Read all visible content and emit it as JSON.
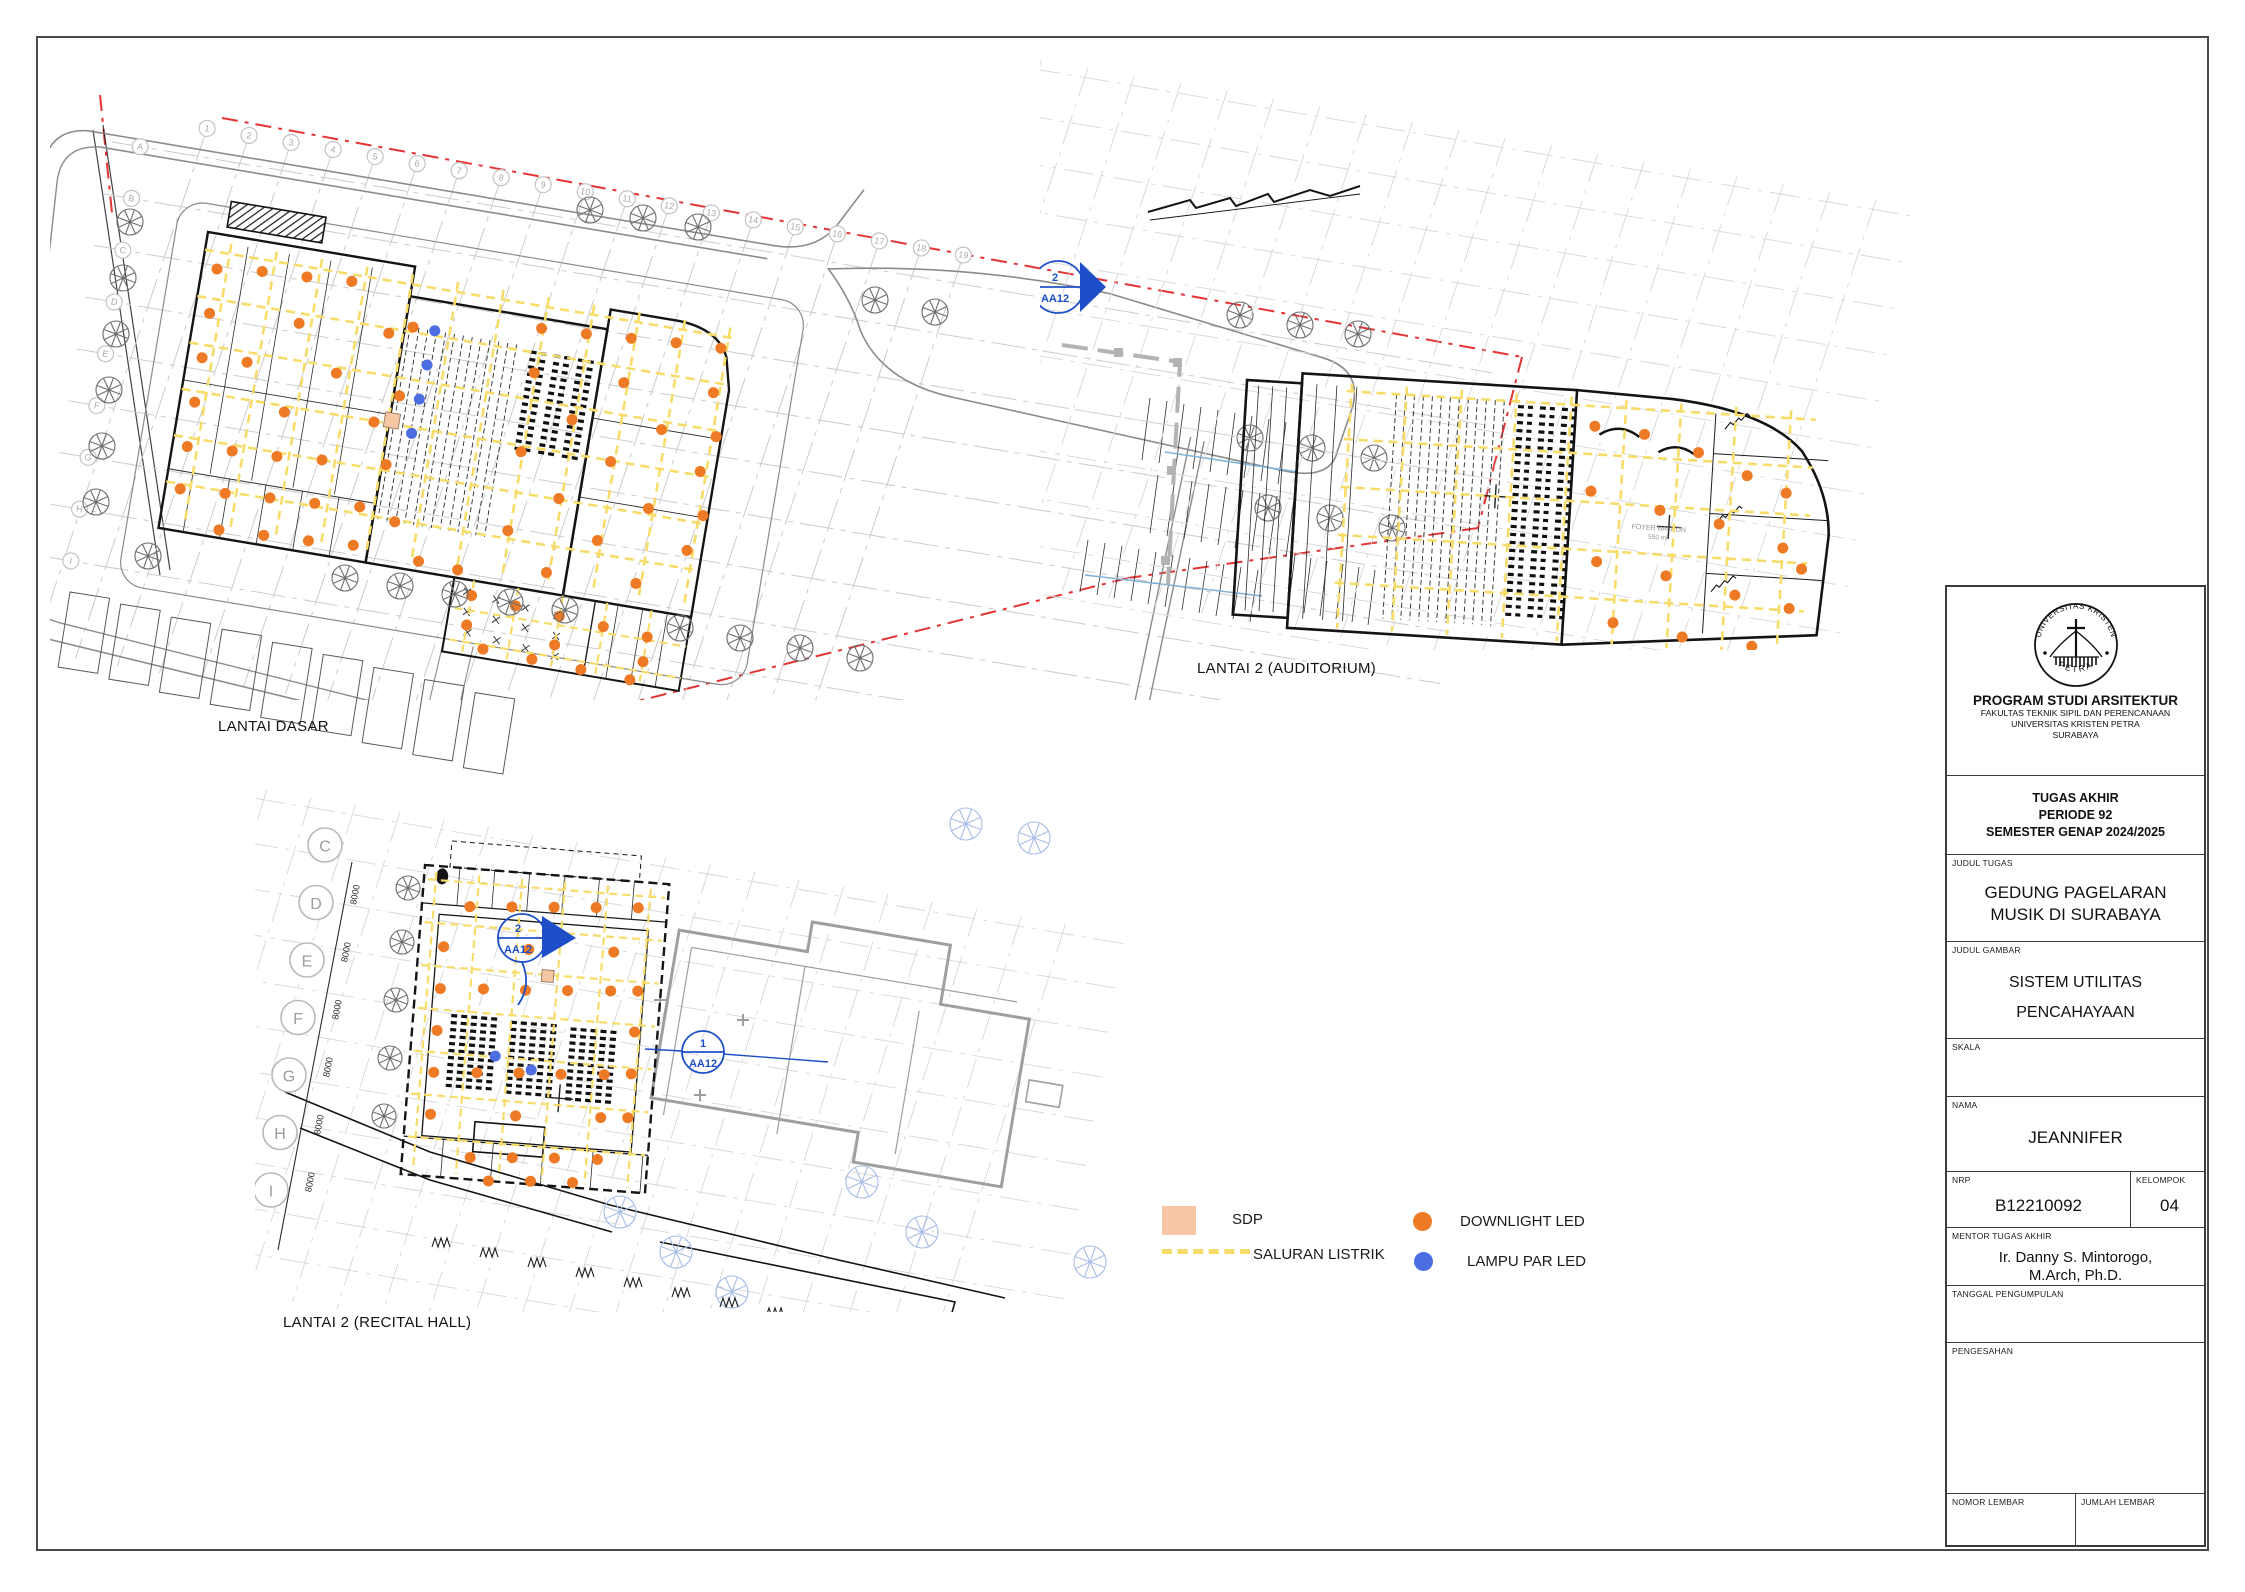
{
  "sheet": {
    "background": "#ffffff",
    "border_color": "#4a4a4a"
  },
  "colors": {
    "downlight": "#ee7a25",
    "lampu_par": "#4d6ee3",
    "saluran": "#f8dc6a",
    "sdp": "#f6c6a5",
    "boundary_red": "#e63434",
    "section_blue": "#1f4fc8",
    "tree_gray": "#6e6e6e",
    "tree_blue": "#a7bde6"
  },
  "plans": {
    "site": {
      "label": "LANTAI DASAR",
      "grid_numbers": [
        "1",
        "2",
        "3",
        "4",
        "5",
        "6",
        "7",
        "8",
        "9",
        "10",
        "11",
        "12",
        "13",
        "14",
        "15",
        "16",
        "17",
        "18",
        "19"
      ],
      "grid_letters": [
        "A",
        "B",
        "C",
        "D",
        "E",
        "F",
        "G",
        "H",
        "I"
      ],
      "orange_dots": [
        [
          15,
          35
        ],
        [
          60,
          30
        ],
        [
          105,
          28
        ],
        [
          150,
          25
        ],
        [
          15,
          80
        ],
        [
          105,
          75
        ],
        [
          195,
          70
        ],
        [
          15,
          125
        ],
        [
          60,
          122
        ],
        [
          150,
          118
        ],
        [
          15,
          170
        ],
        [
          105,
          165
        ],
        [
          195,
          160
        ],
        [
          15,
          215
        ],
        [
          60,
          212
        ],
        [
          105,
          210
        ],
        [
          150,
          206
        ],
        [
          15,
          258
        ],
        [
          60,
          255
        ],
        [
          105,
          252
        ],
        [
          150,
          250
        ],
        [
          195,
          246
        ],
        [
          60,
          292
        ],
        [
          105,
          290
        ],
        [
          150,
          288
        ],
        [
          195,
          285
        ],
        [
          218,
          60
        ],
        [
          216,
          130
        ],
        [
          214,
          200
        ],
        [
          232,
          255
        ],
        [
          262,
          290
        ],
        [
          302,
          292
        ],
        [
          345,
          40
        ],
        [
          390,
          38
        ],
        [
          435,
          35
        ],
        [
          480,
          32
        ],
        [
          525,
          30
        ],
        [
          345,
          85
        ],
        [
          435,
          80
        ],
        [
          525,
          75
        ],
        [
          390,
          125
        ],
        [
          480,
          120
        ],
        [
          535,
          118
        ],
        [
          345,
          165
        ],
        [
          435,
          160
        ],
        [
          525,
          155
        ],
        [
          390,
          205
        ],
        [
          480,
          200
        ],
        [
          535,
          198
        ],
        [
          345,
          245
        ],
        [
          435,
          240
        ],
        [
          525,
          235
        ],
        [
          390,
          280
        ],
        [
          480,
          276
        ],
        [
          320,
          315
        ],
        [
          365,
          318
        ],
        [
          410,
          321
        ],
        [
          455,
          324
        ],
        [
          500,
          327
        ],
        [
          320,
          345
        ],
        [
          410,
          350
        ],
        [
          500,
          352
        ],
        [
          340,
          366
        ],
        [
          390,
          368
        ],
        [
          440,
          370
        ],
        [
          490,
          372
        ]
      ],
      "blue_dots": [
        [
          240,
          60
        ],
        [
          238,
          95
        ],
        [
          236,
          130
        ],
        [
          234,
          165
        ]
      ],
      "sdp_squares": [
        [
          205,
          148,
          15
        ]
      ],
      "trellis_marks": [
        [
          315,
          312
        ],
        [
          345,
          315
        ],
        [
          375,
          318
        ],
        [
          408,
          321
        ],
        [
          318,
          332
        ],
        [
          348,
          335
        ],
        [
          378,
          338
        ],
        [
          410,
          341
        ],
        [
          322,
          352
        ],
        [
          352,
          355
        ],
        [
          382,
          358
        ],
        [
          412,
          361
        ]
      ],
      "trees": [
        [
          130,
          222
        ],
        [
          123,
          278
        ],
        [
          116,
          334
        ],
        [
          109,
          390
        ],
        [
          102,
          446
        ],
        [
          96,
          502
        ],
        [
          148,
          556
        ],
        [
          590,
          210
        ],
        [
          643,
          218
        ],
        [
          698,
          227
        ],
        [
          875,
          300
        ],
        [
          935,
          312
        ],
        [
          1240,
          315
        ],
        [
          1300,
          325
        ],
        [
          1358,
          334
        ],
        [
          345,
          578
        ],
        [
          400,
          586
        ],
        [
          455,
          594
        ],
        [
          510,
          602
        ],
        [
          565,
          610
        ],
        [
          680,
          628
        ],
        [
          740,
          638
        ],
        [
          800,
          648
        ],
        [
          860,
          658
        ],
        [
          1250,
          438
        ],
        [
          1312,
          448
        ],
        [
          1374,
          458
        ],
        [
          1268,
          508
        ],
        [
          1330,
          518
        ],
        [
          1392,
          528
        ]
      ],
      "parking": [
        [
          0,
          0
        ],
        [
          52,
          4
        ],
        [
          104,
          9
        ],
        [
          156,
          13
        ],
        [
          208,
          18
        ],
        [
          260,
          22
        ],
        [
          312,
          27
        ],
        [
          364,
          31
        ],
        [
          416,
          36
        ]
      ]
    },
    "auditorium": {
      "label": "LANTAI 2 (AUDITORIUM)",
      "room_label": "FOYER BALKON",
      "room_area": "550 m²",
      "marker_number": "2",
      "marker_code": "AA12",
      "orange_dots": [
        [
          350,
          40
        ],
        [
          400,
          45
        ],
        [
          455,
          60
        ],
        [
          505,
          80
        ],
        [
          545,
          95
        ],
        [
          350,
          105
        ],
        [
          420,
          120
        ],
        [
          480,
          130
        ],
        [
          545,
          150
        ],
        [
          360,
          175
        ],
        [
          430,
          185
        ],
        [
          500,
          200
        ],
        [
          555,
          210
        ],
        [
          380,
          235
        ],
        [
          450,
          245
        ],
        [
          520,
          250
        ],
        [
          565,
          170
        ]
      ]
    },
    "recital": {
      "label": "LANTAI 2 (RECITAL HALL)",
      "grid_letters": [
        "C",
        "D",
        "E",
        "F",
        "G",
        "H",
        "I"
      ],
      "dim_label": "8000",
      "marker1_number": "2",
      "marker1_code": "AA12",
      "marker2_number": "1",
      "marker2_code": "AA12",
      "orange_dots": [
        [
          48,
          38
        ],
        [
          90,
          35
        ],
        [
          132,
          32
        ],
        [
          174,
          29
        ],
        [
          216,
          26
        ],
        [
          25,
          80
        ],
        [
          110,
          76
        ],
        [
          195,
          72
        ],
        [
          25,
          122
        ],
        [
          68,
          119
        ],
        [
          110,
          117
        ],
        [
          152,
          114
        ],
        [
          195,
          111
        ],
        [
          222,
          109
        ],
        [
          25,
          164
        ],
        [
          222,
          150
        ],
        [
          25,
          206
        ],
        [
          68,
          203
        ],
        [
          110,
          200
        ],
        [
          152,
          198
        ],
        [
          195,
          195
        ],
        [
          222,
          192
        ],
        [
          25,
          248
        ],
        [
          110,
          243
        ],
        [
          195,
          238
        ],
        [
          222,
          236
        ],
        [
          68,
          288
        ],
        [
          110,
          285
        ],
        [
          152,
          282
        ],
        [
          195,
          280
        ],
        [
          88,
          310
        ],
        [
          130,
          307
        ],
        [
          172,
          305
        ]
      ],
      "blue_dots": [
        [
          85,
          185
        ],
        [
          122,
          196
        ]
      ],
      "sdp_squares": [
        [
          125,
          95,
          12
        ]
      ],
      "trees_gray": [
        [
          408,
          888
        ],
        [
          402,
          942
        ],
        [
          396,
          1000
        ],
        [
          390,
          1058
        ],
        [
          384,
          1116
        ]
      ],
      "trees_blue": [
        [
          620,
          1212
        ],
        [
          676,
          1252
        ],
        [
          732,
          1292
        ],
        [
          862,
          1182
        ],
        [
          922,
          1232
        ],
        [
          966,
          824
        ],
        [
          1034,
          838
        ],
        [
          1090,
          1262
        ]
      ],
      "bushes": [
        [
          432,
          1247
        ],
        [
          480,
          1257
        ],
        [
          528,
          1267
        ],
        [
          576,
          1277
        ],
        [
          624,
          1287
        ],
        [
          672,
          1297
        ],
        [
          720,
          1307
        ],
        [
          766,
          1317
        ]
      ]
    }
  },
  "legend": {
    "sdp_label": "SDP",
    "saluran_label": "SALURAN LISTRIK",
    "downlight_label": "DOWNLIGHT LED",
    "lampu_label": "LAMPU PAR LED"
  },
  "title_block": {
    "logo_top": "UNIVERSITAS KRISTEN",
    "logo_bottom": "PETRA",
    "dept": "PROGRAM STUDI ARSITEKTUR",
    "faculty": "FAKULTAS TEKNIK SIPIL DAN PERENCANAAN",
    "university": "UNIVERSITAS KRISTEN PETRA",
    "city": "SURABAYA",
    "task1": "TUGAS AKHIR",
    "task2": "PERIODE 92",
    "task3": "SEMESTER GENAP 2024/2025",
    "judul_tugas_label": "JUDUL TUGAS",
    "judul_tugas_1": "GEDUNG PAGELARAN",
    "judul_tugas_2": "MUSIK DI SURABAYA",
    "judul_gambar_label": "JUDUL GAMBAR",
    "judul_gambar_1": "SISTEM UTILITAS",
    "judul_gambar_2": "PENCAHAYAAN",
    "skala_label": "SKALA",
    "nama_label": "NAMA",
    "nama": "JEANNIFER",
    "nrp_label": "NRP",
    "nrp": "B12210092",
    "kelompok_label": "KELOMPOK",
    "kelompok": "04",
    "mentor_label": "MENTOR TUGAS AKHIR",
    "mentor_1": "Ir. Danny S. Mintorogo,",
    "mentor_2": "M.Arch, Ph.D.",
    "tanggal_label": "TANGGAL PENGUMPULAN",
    "pengesahan_label": "PENGESAHAN",
    "nomor_label": "NOMOR LEMBAR",
    "jumlah_label": "JUMLAH LEMBAR"
  }
}
